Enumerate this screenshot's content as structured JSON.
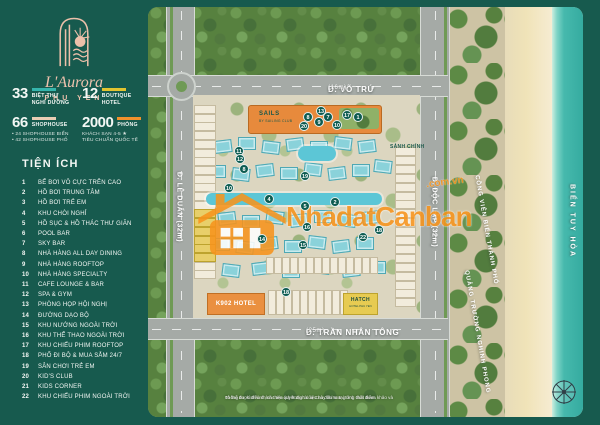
{
  "brand": {
    "name": "L'Aurora",
    "location": "PHU YEN"
  },
  "stats": [
    {
      "value": "33",
      "bar_color": "#35b5ac",
      "label": "BIỆT THỰ\nNGHỈ DƯỠNG",
      "notes": []
    },
    {
      "value": "12",
      "bar_color": "#e3c42f",
      "label": "BOUTIQUE\nHOTEL",
      "notes": []
    },
    {
      "value": "66",
      "bar_color": "#e9cdb4",
      "label": "SHOPHOUSE",
      "notes": [
        "• 24 SHOPHOUSE BIỂN",
        "• 42 SHOPHOUSE PHỐ"
      ]
    },
    {
      "value": "2000",
      "bar_color": "#f0912c",
      "label": "PHÒNG",
      "notes": [
        "KHÁCH SẠN 4-5 ★",
        "TIÊU CHUẨN QUỐC TẾ"
      ]
    }
  ],
  "amenities": {
    "title": "TIỆN ÍCH",
    "items": [
      {
        "n": "1",
        "label": "BỂ BƠI VÔ CỰC TRÊN CAO"
      },
      {
        "n": "2",
        "label": "HỒ BƠI TRUNG TÂM"
      },
      {
        "n": "3",
        "label": "HỒ BƠI TRẺ EM"
      },
      {
        "n": "4",
        "label": "KHU CHÒI NGHỈ"
      },
      {
        "n": "5",
        "label": "HỒ SỤC & HỒ THÁC THƯ GIÃN"
      },
      {
        "n": "6",
        "label": "POOL BAR"
      },
      {
        "n": "7",
        "label": "SKY BAR"
      },
      {
        "n": "8",
        "label": "NHÀ HÀNG ALL DAY DINING"
      },
      {
        "n": "9",
        "label": "NHÀ HÀNG ROOFTOP"
      },
      {
        "n": "10",
        "label": "NHÀ HÀNG SPECIALTY"
      },
      {
        "n": "11",
        "label": "CAFE LOUNGE & BAR"
      },
      {
        "n": "12",
        "label": "SPA & GYM"
      },
      {
        "n": "13",
        "label": "PHÒNG HỌP HỘI NGHỊ"
      },
      {
        "n": "14",
        "label": "ĐƯỜNG DẠO BỘ"
      },
      {
        "n": "15",
        "label": "KHU NƯỚNG NGOÀI TRỜI"
      },
      {
        "n": "16",
        "label": "KHU THỂ THAO NGOÀI TRỜI"
      },
      {
        "n": "17",
        "label": "KHU CHIẾU PHIM ROOFTOP"
      },
      {
        "n": "18",
        "label": "PHỐ ĐI BỘ & MUA SẮM 24/7"
      },
      {
        "n": "19",
        "label": "SÂN CHƠI TRẺ EM"
      },
      {
        "n": "20",
        "label": "KID'S CLUB"
      },
      {
        "n": "21",
        "label": "KIDS CORNER"
      },
      {
        "n": "22",
        "label": "KHU CHIẾU PHIM NGOÀI TRỜI"
      }
    ]
  },
  "map": {
    "streets": {
      "vo_tru": "Đ. VÕ TRỨ",
      "vo_tru_width": "(16m)",
      "le_duan": "Đ. LÊ DUẨN (32m)",
      "doc_lap": "Đ. ĐỘC LẬP (32m)",
      "tran_nhan_tong": "Đ. TRẦN NHÂN TÔNG",
      "tran_nhan_tong_width": "(25m)"
    },
    "places": {
      "sails_line1": "SAILS",
      "sails_line2": "BY SAILING CLUB",
      "k902": "K902 HOTEL",
      "hatch_line1": "HATCH",
      "hatch_line2": "HOTEL PHU YEN",
      "lobby": "SẢNH CHÍNH",
      "park": "CÔNG VIÊN BIỂN THÀNH PHỐ",
      "square": "QUẢNG TRƯỜNG NGHINH PHONG",
      "sea": "BIỂN TUY HÒA"
    },
    "badges": [
      {
        "n": "8",
        "x": 160,
        "y": 110
      },
      {
        "n": "13",
        "x": 173,
        "y": 104
      },
      {
        "n": "9",
        "x": 171,
        "y": 115
      },
      {
        "n": "7",
        "x": 180,
        "y": 110
      },
      {
        "n": "10",
        "x": 189,
        "y": 118
      },
      {
        "n": "17",
        "x": 199,
        "y": 108
      },
      {
        "n": "1",
        "x": 210,
        "y": 110
      },
      {
        "n": "20",
        "x": 156,
        "y": 119
      },
      {
        "n": "11",
        "x": 91,
        "y": 144
      },
      {
        "n": "12",
        "x": 92,
        "y": 152
      },
      {
        "n": "8",
        "x": 96,
        "y": 162
      },
      {
        "n": "19",
        "x": 157,
        "y": 169
      },
      {
        "n": "10",
        "x": 81,
        "y": 181
      },
      {
        "n": "4",
        "x": 121,
        "y": 192
      },
      {
        "n": "5",
        "x": 157,
        "y": 199
      },
      {
        "n": "2",
        "x": 187,
        "y": 195
      },
      {
        "n": "16",
        "x": 159,
        "y": 220
      },
      {
        "n": "14",
        "x": 114,
        "y": 232
      },
      {
        "n": "15",
        "x": 155,
        "y": 238
      },
      {
        "n": "22",
        "x": 215,
        "y": 230
      },
      {
        "n": "18",
        "x": 231,
        "y": 223
      },
      {
        "n": "18",
        "x": 138,
        "y": 285
      }
    ],
    "watermark": {
      "text": "NhadatCanban",
      "suffix": ".com.vn"
    },
    "disclaimer": {
      "line1": "Thông tin, hình ảnh, các tiện ích trong tài liệu này chỉ mang tính chất tham khảo và",
      "line2": "có thể được điều chỉnh theo quyết định của Chủ đầu tư tại từng thời điểm."
    }
  }
}
